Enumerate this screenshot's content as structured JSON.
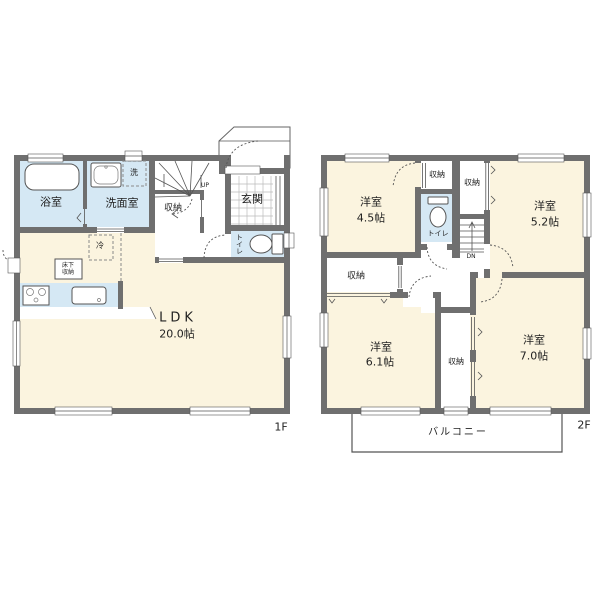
{
  "colors": {
    "wall": "#6f6f6f",
    "cream": "#fbf4df",
    "wet": "#d5e8f4",
    "line": "#555555"
  },
  "floor1": {
    "label": "1F",
    "bath": "浴室",
    "washroom": "洗面室",
    "laundry": "洗",
    "closet": "収納",
    "up": "UP",
    "entrance": "玄関",
    "toilet": "トイレ",
    "fridge": "冷",
    "underfloor1": "床下",
    "underfloor2": "収納",
    "ldk": "LDK",
    "ldk_size": "20.0帖"
  },
  "floor2": {
    "label": "2F",
    "room45": "洋室",
    "room45_size": "4.5帖",
    "closet_a": "収納",
    "closet_b": "収納",
    "toilet": "トイレ",
    "dn": "DN",
    "room52": "洋室",
    "room52_size": "5.2帖",
    "closet_c": "収納",
    "room61": "洋室",
    "room61_size": "6.1帖",
    "closet_d": "収納",
    "room70": "洋室",
    "room70_size": "7.0帖",
    "balcony": "バルコニー"
  }
}
